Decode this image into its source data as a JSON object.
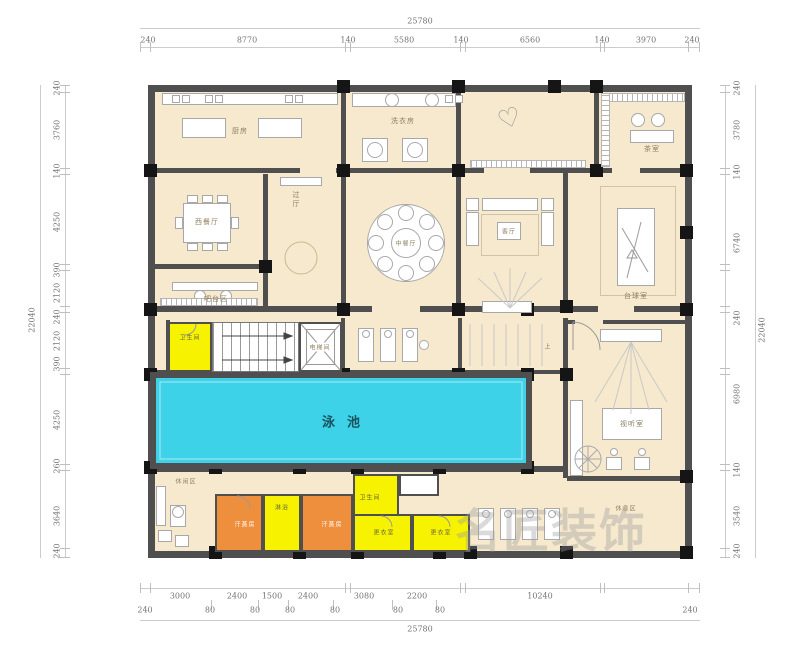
{
  "dims": {
    "top": {
      "total": "25780",
      "segments": [
        "240",
        "8770",
        "140",
        "5580",
        "140",
        "6560",
        "140",
        "3970",
        "240"
      ]
    },
    "bottom": {
      "total": "25780",
      "row1": [
        "3000",
        "2400",
        "1500",
        "2400",
        "3080",
        "2200",
        "10240"
      ],
      "row2": [
        "240",
        "80",
        "80",
        "80",
        "80",
        "80",
        "80",
        "240"
      ]
    },
    "left": {
      "total": "22040",
      "segments": [
        "240",
        "3760",
        "140",
        "4250",
        "390",
        "2120",
        "240",
        "2120",
        "390",
        "4250",
        "260",
        "3640",
        "240"
      ]
    },
    "right": {
      "total": "22040",
      "segments": [
        "240",
        "3780",
        "140",
        "6740",
        "240",
        "6980",
        "140",
        "3540",
        "240"
      ]
    }
  },
  "rooms": {
    "kitchen": "厨房",
    "laundry": "洗衣房",
    "tea_room": "茶室",
    "west_dining": "西餐厅",
    "bar_area": "吧台区",
    "hall": "过厅",
    "chinese_dining": "中餐厅",
    "living": "客厅",
    "billiards": "台球室",
    "elevator": "电梯间",
    "wc_left": "卫生间",
    "pool": "泳池",
    "sauna_left": "汗蒸房",
    "shower": "淋浴",
    "sauna_right": "汗蒸房",
    "wc_right": "卫生间",
    "changing_1": "更衣室",
    "changing_2": "更衣室",
    "lounge": "休闲区",
    "av_room": "视听室",
    "rest_area": "休息区",
    "stair_up": "上"
  },
  "watermark": "名匠装饰",
  "colors": {
    "wall": "#4f4f4f",
    "room_fill": "#f6e9cd",
    "pool": "#3ed2e8",
    "yellow": "#f6f200",
    "orange": "#ee8f3d"
  }
}
